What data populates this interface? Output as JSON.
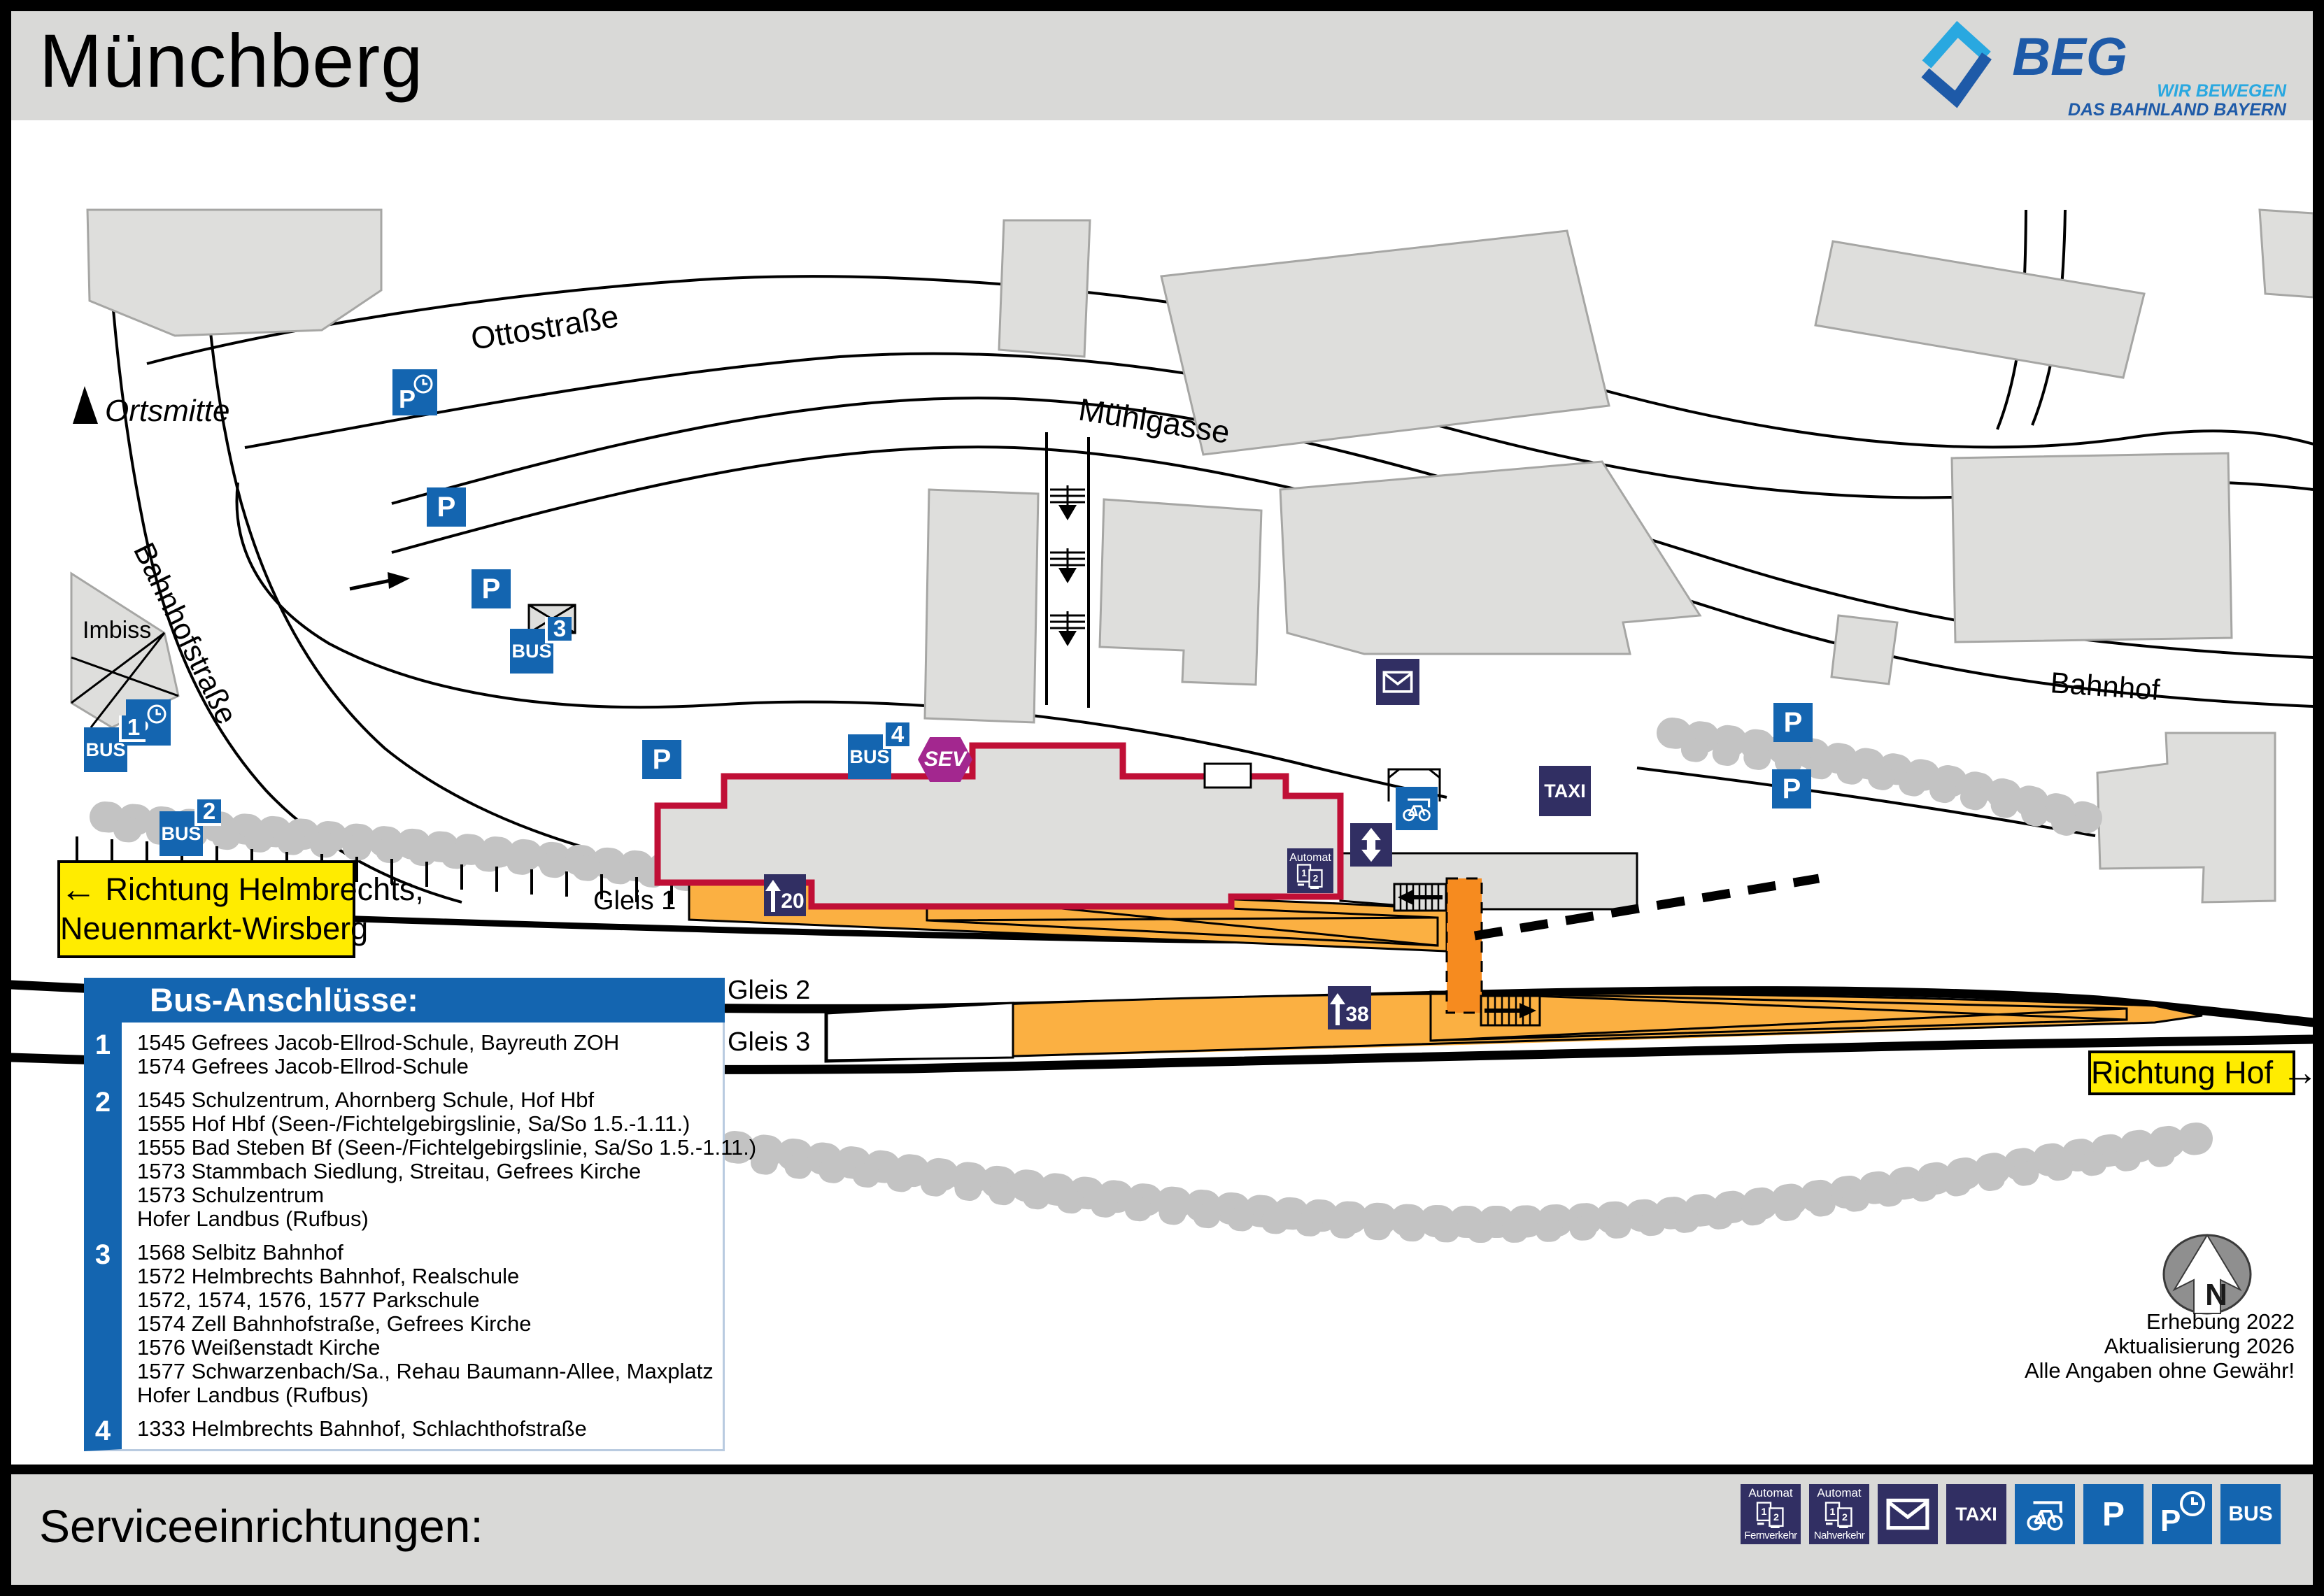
{
  "header": {
    "title": "Münchberg",
    "urls": [
      "www.bahnland-bayern.de",
      "www.moby.bayern"
    ],
    "logo": {
      "name": "BEG",
      "tagline1": "WIR BEWEGEN",
      "tagline2": "DAS BAHNLAND BAYERN"
    },
    "credit": {
      "symbol": "©",
      "part1": "BAHN",
      "part2": "STADT"
    }
  },
  "map": {
    "streets": [
      {
        "id": "ottostrasse",
        "label": "Ottostraße"
      },
      {
        "id": "muehlgasse",
        "label": "Mühlgasse"
      },
      {
        "id": "bahnhofstrasse",
        "label": "Bahnhofstraße"
      },
      {
        "id": "bahnhof",
        "label": "Bahnhof"
      }
    ],
    "pois": [
      {
        "id": "ortsmitte",
        "label": "Ortsmitte"
      },
      {
        "id": "imbiss",
        "label": "Imbiss"
      }
    ],
    "gleis_labels": [
      "Gleis 1",
      "Gleis 2",
      "Gleis 3"
    ],
    "platform_markers": [
      {
        "gleis": "1",
        "length": "120",
        "digits": "20"
      },
      {
        "gleis": "2/3",
        "length": "138",
        "digits": "38"
      }
    ],
    "signs": [
      {
        "id": "direction-west",
        "arrow": "←",
        "line1": "Richtung Helmbrechts,",
        "line2": "Neuenmarkt-Wirsberg"
      },
      {
        "id": "direction-east",
        "label": "Richtung Hof",
        "arrow": "→"
      }
    ],
    "p_label": "P",
    "bus_label": "BUS",
    "sev_label": "SEV",
    "taxi_label": "TAXI",
    "automat_label": "Automat",
    "bus_stops": [
      {
        "number": "1"
      },
      {
        "number": "2"
      },
      {
        "number": "3"
      },
      {
        "number": "4"
      }
    ],
    "compass_letter": "N",
    "survey": [
      "Erhebung 2022",
      "Aktualisierung 2026",
      "Alle Angaben ohne Gewähr!"
    ]
  },
  "legend": {
    "title": "Bus-Anschlüsse:",
    "groups": [
      {
        "number": "1",
        "lines": [
          "1545 Gefrees Jacob-Ellrod-Schule, Bayreuth ZOH",
          "1574 Gefrees Jacob-Ellrod-Schule"
        ]
      },
      {
        "number": "2",
        "lines": [
          "1545 Schulzentrum, Ahornberg Schule, Hof Hbf",
          "1555 Hof Hbf (Seen-/Fichtelgebirgslinie, Sa/So 1.5.-1.11.)",
          "1555 Bad Steben Bf (Seen-/Fichtelgebirgslinie, Sa/So 1.5.-1.11.)",
          "1573 Stammbach Siedlung, Streitau, Gefrees Kirche",
          "1573 Schulzentrum",
          "Hofer Landbus (Rufbus)"
        ]
      },
      {
        "number": "3",
        "lines": [
          "1568 Selbitz Bahnhof",
          "1572 Helmbrechts Bahnhof, Realschule",
          "1572, 1574, 1576, 1577 Parkschule",
          "1574 Zell Bahnhofstraße, Gefrees Kirche",
          "1576 Weißenstadt Kirche",
          "1577 Schwarzenbach/Sa., Rehau Baumann-Allee, Maxplatz",
          "Hofer Landbus (Rufbus)"
        ]
      },
      {
        "number": "4",
        "lines": [
          "1333 Helmbrechts Bahnhof, Schlachthofstraße"
        ]
      }
    ]
  },
  "footer": {
    "title": "Serviceeinrichtungen:",
    "icons": [
      {
        "name": "automat-fernverkehr",
        "label_top": "Automat",
        "label_bottom": "Fernverkehr"
      },
      {
        "name": "automat-nahverkehr",
        "label_top": "Automat",
        "label_bottom": "Nahverkehr"
      },
      {
        "name": "mail"
      },
      {
        "name": "taxi",
        "label": "TAXI"
      },
      {
        "name": "bike-shelter"
      },
      {
        "name": "parking",
        "label": "P"
      },
      {
        "name": "parking-time",
        "label": "P"
      },
      {
        "name": "bus",
        "label": "BUS"
      }
    ]
  },
  "colors": {
    "accent_blue": "#1465B0",
    "navy": "#312F63",
    "sev_purple": "#A3278F",
    "platform_orange": "#FBB042",
    "crossing_orange": "#F68B1F",
    "building_red": "#C00F36",
    "sign_yellow": "#FFEC00",
    "link_blue": "#1789D7"
  }
}
